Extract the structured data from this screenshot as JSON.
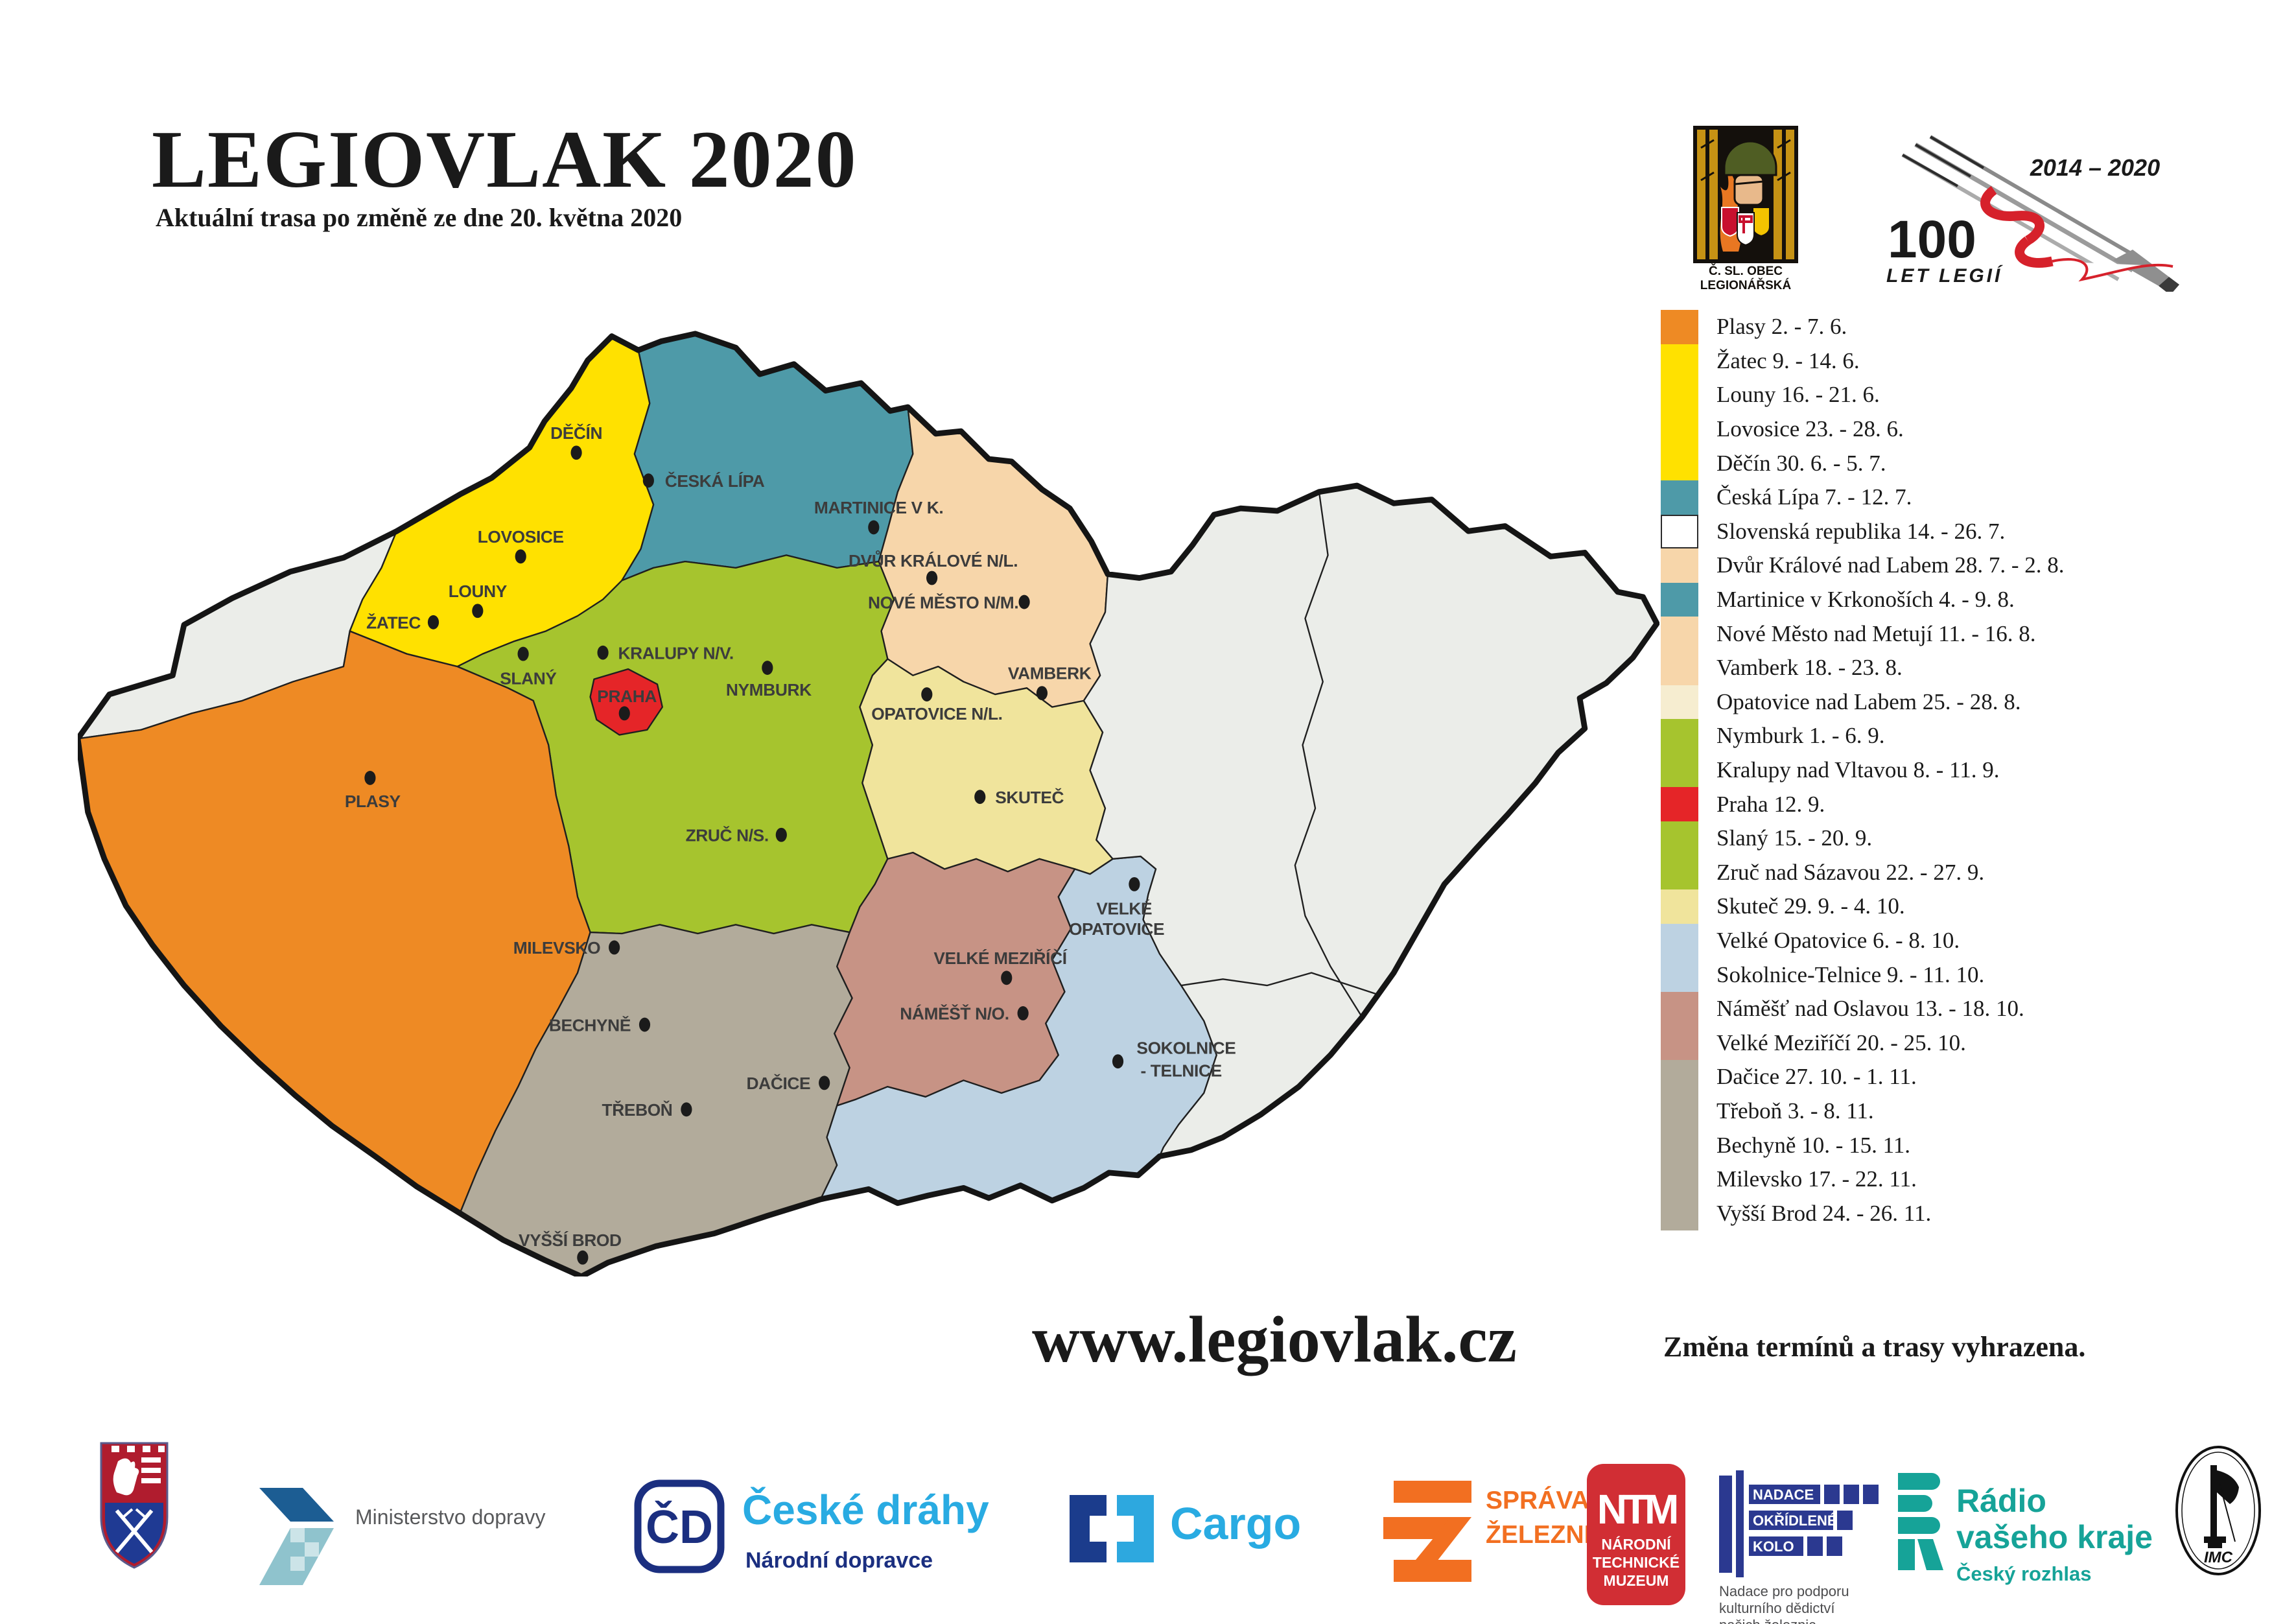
{
  "page": {
    "title": "LEGIOVLAK 2020",
    "subtitle": "Aktuální trasa po změně ze dne 20. května 2020",
    "website": "www.legiovlak.cz",
    "disclaimer": "Změna termínů a trasy vyhrazena."
  },
  "header_logos": {
    "csol": {
      "line1": "Č. SL. OBEC",
      "line2": "LEGIONÁŘSKÁ"
    },
    "legie100": {
      "years": "2014 – 2020",
      "big": "100",
      "sub": "LET LEGIÍ"
    }
  },
  "legend": {
    "items": [
      {
        "label": "Plasy 2. - 7. 6.",
        "color": "#EE8A24"
      },
      {
        "label": "Žatec 9. - 14. 6.",
        "color": "#FFE100"
      },
      {
        "label": "Louny 16. - 21. 6.",
        "color": "#FFE100"
      },
      {
        "label": "Lovosice 23. - 28. 6.",
        "color": "#FFE100"
      },
      {
        "label": "Děčín 30. 6. - 5. 7.",
        "color": "#FFE100"
      },
      {
        "label": "Česká Lípa 7. - 12. 7.",
        "color": "#4E9AA8"
      },
      {
        "label": "Slovenská republika 14. - 26. 7.",
        "color": "#FFFFFF"
      },
      {
        "label": "Dvůr Králové nad Labem 28. 7. - 2. 8.",
        "color": "#F7D6AA"
      },
      {
        "label": "Martinice v Krkonoších 4. - 9. 8.",
        "color": "#4E9AA8"
      },
      {
        "label": "Nové Město nad Metují 11. - 16. 8.",
        "color": "#F7D6AA"
      },
      {
        "label": "Vamberk 18. - 23. 8.",
        "color": "#F7D6AA"
      },
      {
        "label": "Opatovice nad Labem 25. - 28. 8.",
        "color": "#F6EDD0"
      },
      {
        "label": "Nymburk 1. - 6. 9.",
        "color": "#A6C42E"
      },
      {
        "label": "Kralupy nad Vltavou 8. - 11. 9.",
        "color": "#A6C42E"
      },
      {
        "label": "Praha 12. 9.",
        "color": "#E52528"
      },
      {
        "label": "Slaný 15. - 20. 9.",
        "color": "#A6C42E"
      },
      {
        "label": "Zruč nad Sázavou 22. - 27. 9.",
        "color": "#A6C42E"
      },
      {
        "label": "Skuteč 29. 9. - 4. 10.",
        "color": "#F0E49C"
      },
      {
        "label": "Velké Opatovice 6. - 8. 10.",
        "color": "#BDD2E2"
      },
      {
        "label": "Sokolnice-Telnice 9. - 11. 10.",
        "color": "#BDD2E2"
      },
      {
        "label": "Náměšť nad Oslavou 13. - 18. 10.",
        "color": "#C79385"
      },
      {
        "label": "Velké Meziříčí 20. - 25. 10.",
        "color": "#C79385"
      },
      {
        "label": "Dačice 27. 10. - 1. 11.",
        "color": "#B2AB9B"
      },
      {
        "label": "Třeboň 3. - 8. 11.",
        "color": "#B2AB9B"
      },
      {
        "label": "Bechyně 10. - 15. 11.",
        "color": "#B2AB9B"
      },
      {
        "label": "Milevsko 17. - 22. 11.",
        "color": "#B2AB9B"
      },
      {
        "label": "Vyšší Brod 24. - 26. 11.",
        "color": "#B2AB9B"
      }
    ]
  },
  "map": {
    "dot_color": "#1b1b1b",
    "label_color": "#3c3c3c",
    "region_colors": {
      "unvisited": "#EBEDE9",
      "usti": "#FFE100",
      "liberec": "#4E9AA8",
      "hradec": "#F7D6AA",
      "pardubice": "#F0E49C",
      "central": "#A6C42E",
      "praha": "#E52528",
      "plzen": "#EE8A24",
      "south_bohemia": "#B2AB9B",
      "vysocina": "#C79385",
      "south_moravia": "#BDD2E2"
    },
    "labels": [
      {
        "text": "DĚČÍN"
      },
      {
        "text": "ČESKÁ LÍPA"
      },
      {
        "text": "MARTINICE V K."
      },
      {
        "text": "LOVOSICE"
      },
      {
        "text": "LOUNY"
      },
      {
        "text": "ŽATEC"
      },
      {
        "text": "SLANÝ"
      },
      {
        "text": "KRALUPY N/V."
      },
      {
        "text": "PRAHA"
      },
      {
        "text": "NYMBURK"
      },
      {
        "text": "DVŮR KRÁLOVÉ N/L."
      },
      {
        "text": "NOVÉ MĚSTO N/M."
      },
      {
        "text": "VAMBERK"
      },
      {
        "text": "OPATOVICE N/L."
      },
      {
        "text": "SKUTEČ"
      },
      {
        "text": "ZRUČ N/S."
      },
      {
        "text": "PLASY"
      },
      {
        "text": "MILEVSKO"
      },
      {
        "text": "BECHYNĚ"
      },
      {
        "text": "TŘEBOŇ"
      },
      {
        "text": "DAČICE"
      },
      {
        "text": "VYŠŠÍ BROD"
      },
      {
        "text": "VELKÉ MEZIŘÍČÍ"
      },
      {
        "text": "NÁMĚŠŤ N/O."
      },
      {
        "text": "VELKÉ"
      },
      {
        "text": "OPATOVICE"
      },
      {
        "text": "SOKOLNICE"
      },
      {
        "text": "- TELNICE"
      }
    ]
  },
  "footer": {
    "ministerstvo": "Ministerstvo dopravy",
    "cd_name": "České dráhy",
    "cd_sub": "Národní dopravce",
    "cd_monogram": "ČD",
    "cargo": "Cargo",
    "sprava1": "SPRÁVA",
    "sprava2": "ŽELEZNIC",
    "ntm_monogram": "NTM",
    "ntm1": "NÁRODNÍ",
    "ntm2": "TECHNICKÉ",
    "ntm3": "MUZEUM",
    "nadace1": "NADACE",
    "nadace2": "OKŘÍDLENÉ",
    "nadace3": "KOLO",
    "nadace_cap1": "Nadace pro podporu",
    "nadace_cap2": "kulturního dědictví",
    "nadace_cap3": "našich železnic",
    "rozhlas1": "Rádio",
    "rozhlas2": "vašeho kraje",
    "rozhlas3": "Český rozhlas",
    "imc": "IMC"
  }
}
